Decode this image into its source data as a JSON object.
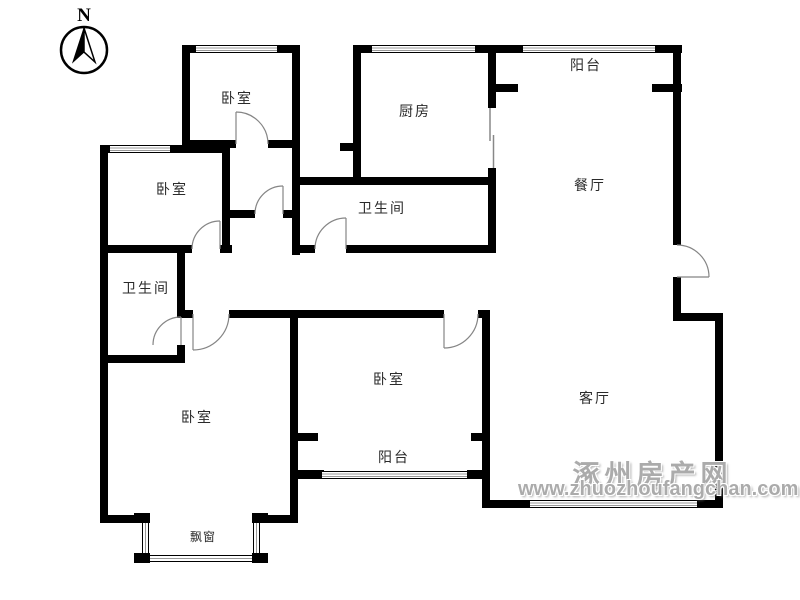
{
  "page": {
    "background": "#ffffff"
  },
  "floor_plan": {
    "wall_color": "#000000",
    "door_arc_color": "#858585",
    "window_inner_line_color": "#999999"
  },
  "compass": {
    "north_label": "N"
  },
  "rooms": {
    "bedroom_top": "卧室",
    "kitchen": "厨房",
    "balcony_top": "阳台",
    "dining_room": "餐厅",
    "bedroom_mid_left": "卧室",
    "bathroom_top": "卫生间",
    "bathroom_left": "卫生间",
    "bedroom_bottom_left": "卧室",
    "bedroom_bottom_mid": "卧室",
    "balcony_bottom": "阳台",
    "living_room": "客厅",
    "bay_window": "飘窗"
  },
  "watermark": {
    "site_name": "涿州房产网",
    "site_url": "www.zhuozhoufangchan.com",
    "color": "#ababab"
  }
}
